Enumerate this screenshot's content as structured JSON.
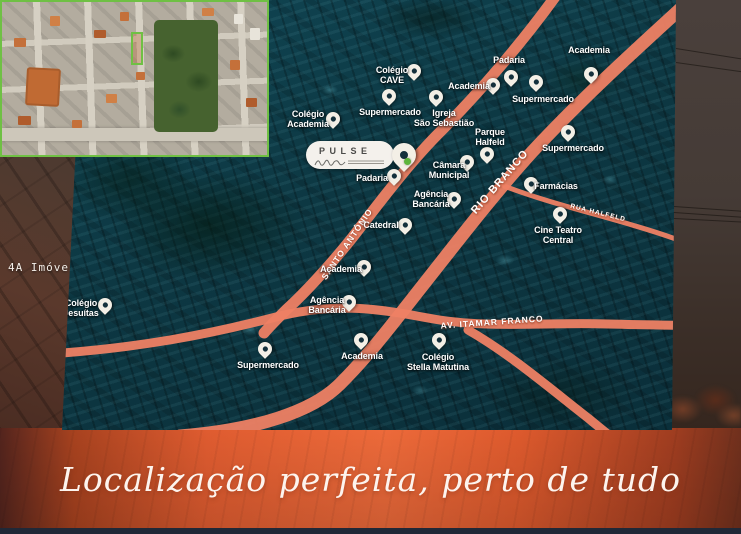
{
  "watermark": "4A Imóveis",
  "tagline": "Localização perfeita, perto de tudo",
  "logo": {
    "name": "PULSE"
  },
  "colors": {
    "accent_green": "#6fc044",
    "road_salmon": "#ee8164",
    "map_teal": "#0d3843",
    "band_orange": "#ed6a3a",
    "pin_white": "#f3efe6",
    "pin_hole": "#14303c"
  },
  "map": {
    "road_labels": [
      {
        "text": "SANTO ANTÔNIO",
        "x": 347,
        "y": 244,
        "rotate": -56,
        "size": 8.5
      },
      {
        "text": "RIO BRANCO",
        "x": 500,
        "y": 182,
        "rotate": -49,
        "size": 11
      },
      {
        "text": "RUA HALFELD",
        "x": 598,
        "y": 213,
        "rotate": 14,
        "size": 6.5
      },
      {
        "text": "AV. ITAMAR FRANCO",
        "x": 492,
        "y": 322,
        "rotate": -4,
        "size": 8.5
      }
    ],
    "pois": [
      {
        "label": "Colégio\nCAVE",
        "lx": 392,
        "ly": 76,
        "px": 414,
        "py": 81
      },
      {
        "label": "Padaria",
        "lx": 509,
        "ly": 61,
        "px": 511,
        "py": 87
      },
      {
        "label": "Academia",
        "lx": 469,
        "ly": 87,
        "px": 493,
        "py": 95
      },
      {
        "label": "Academia",
        "lx": 589,
        "ly": 51,
        "px": 591,
        "py": 84
      },
      {
        "label": "Supermercado",
        "lx": 543,
        "ly": 100,
        "px": 536,
        "py": 92
      },
      {
        "label": "Supermercado",
        "lx": 390,
        "ly": 113,
        "px": 389,
        "py": 106
      },
      {
        "label": "Igreja\nSão Sebastião",
        "lx": 444,
        "ly": 119,
        "px": 436,
        "py": 107
      },
      {
        "label": "Colégio\nAcademia",
        "lx": 308,
        "ly": 120,
        "px": 333,
        "py": 129
      },
      {
        "label": "Parque\nHalfeld",
        "lx": 490,
        "ly": 138,
        "px": 487,
        "py": 164
      },
      {
        "label": "Supermercado",
        "lx": 573,
        "ly": 149,
        "px": 568,
        "py": 142
      },
      {
        "label": "Câmara\nMunicipal",
        "lx": 449,
        "ly": 171,
        "px": 467,
        "py": 172
      },
      {
        "label": "Padaria",
        "lx": 372,
        "ly": 179,
        "px": 394,
        "py": 186
      },
      {
        "label": "Agência\nBancária",
        "lx": 431,
        "ly": 200,
        "px": 454,
        "py": 209
      },
      {
        "label": "Farmácias",
        "lx": 556,
        "ly": 187,
        "px": 531,
        "py": 194
      },
      {
        "label": "Catedral",
        "lx": 381,
        "ly": 226,
        "px": 405,
        "py": 235
      },
      {
        "label": "Cine Teatro\nCentral",
        "lx": 558,
        "ly": 236,
        "px": 560,
        "py": 224
      },
      {
        "label": "Academia",
        "lx": 341,
        "ly": 270,
        "px": 364,
        "py": 277
      },
      {
        "label": "Agência\nBancária",
        "lx": 327,
        "ly": 306,
        "px": 349,
        "py": 312
      },
      {
        "label": "Colégio\nJesuítas",
        "lx": 81,
        "ly": 309,
        "px": 105,
        "py": 315
      },
      {
        "label": "Supermercado",
        "lx": 268,
        "ly": 366,
        "px": 265,
        "py": 359
      },
      {
        "label": "Academia",
        "lx": 362,
        "ly": 357,
        "px": 361,
        "py": 350
      },
      {
        "label": "Colégio\nStella Matutina",
        "lx": 438,
        "ly": 363,
        "px": 439,
        "py": 350
      }
    ]
  }
}
